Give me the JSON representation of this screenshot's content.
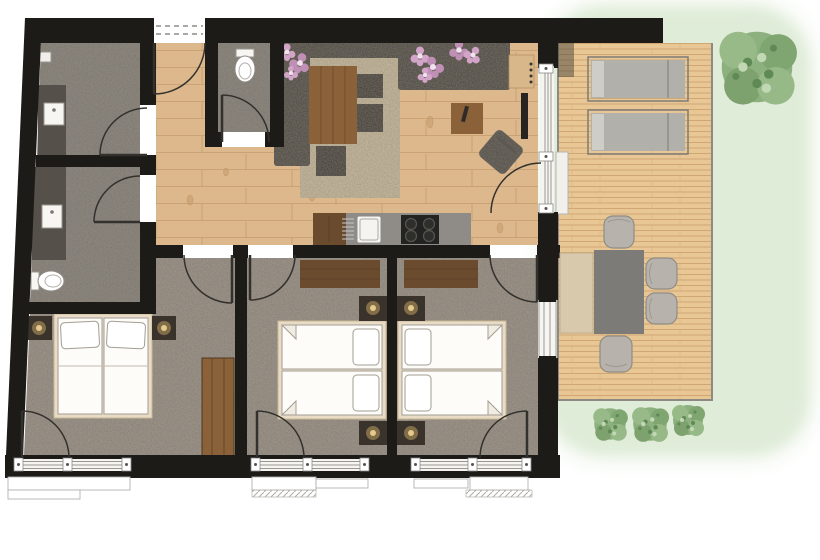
{
  "scene": {
    "kind": "apartment-floor-plan",
    "view": "top-down"
  },
  "palette": {
    "background": "#ffffff",
    "wall": "#1d1b18",
    "wood_floor": "#dcb88c",
    "tile": "#938d85",
    "carpet": "#a29a8f",
    "rug": "#cabda3",
    "sofa": "#403d39",
    "deck": "#e8c795",
    "deck_edge": "#8d8a84",
    "grass": "#dfecd8",
    "grass_halo": "#eef5ea",
    "tree": "#8cb07e",
    "bed_frame": "#e9dcc6",
    "bed_linen": "#fdfcf8",
    "pillow_accent": "#d2a4c8",
    "pillow_accent_dark": "#bf8fb5",
    "furniture_wood": "#8a6138",
    "dark_wood": "#6b4b2d",
    "counter": "#8f8c87",
    "cooktop": "#232321",
    "sink": "#f5f4f1",
    "lounger": "#b2b0ab",
    "outdoor_chair": "#b7b3ac",
    "outdoor_table": "#7d7b78",
    "bench": "#d9c9ac",
    "lamp_glow": "#caa768",
    "glazing": "#9a9792",
    "window_frame": "#f6f5f2",
    "door_arc": "#33312d"
  },
  "rooms": [
    {
      "name": "shower-room",
      "floor": "tile",
      "fixtures": [
        "vanity-washbasin",
        "swing-door"
      ]
    },
    {
      "name": "bathroom",
      "floor": "tile",
      "fixtures": [
        "vanity-washbasin",
        "toilet",
        "swing-door"
      ]
    },
    {
      "name": "wc",
      "floor": "tile",
      "fixtures": [
        "toilet",
        "swing-door"
      ]
    },
    {
      "name": "entrance-hall",
      "floor": "wood",
      "fixtures": [
        "entrance-door"
      ]
    },
    {
      "name": "living-dining-kitchen",
      "floor": "wood",
      "fixtures": [
        "corner-sofa",
        "flower-pillows",
        "rug",
        "coffee-table",
        "side-cubes",
        "stool",
        "side-table",
        "armchair",
        "tv",
        "wall-shelf",
        "kitchen-counter",
        "sink",
        "cooktop",
        "terrace-glass-door"
      ]
    },
    {
      "name": "bedroom-west",
      "floor": "carpet",
      "fixtures": [
        "double-bed",
        "nightstand",
        "nightstand",
        "wardrobe",
        "garden-door",
        "window"
      ]
    },
    {
      "name": "bedroom-middle",
      "floor": "carpet",
      "fixtures": [
        "double-bed",
        "nightstand",
        "nightstand",
        "sideboard",
        "garden-door",
        "window"
      ]
    },
    {
      "name": "bedroom-east",
      "floor": "carpet",
      "fixtures": [
        "double-bed",
        "nightstand",
        "nightstand",
        "sideboard",
        "garden-door",
        "window"
      ]
    },
    {
      "name": "terrace",
      "floor": "deck",
      "fixtures": [
        "sun-lounger",
        "sun-lounger",
        "dining-table",
        "bench",
        "chair",
        "chair",
        "chair",
        "chair",
        "step"
      ]
    },
    {
      "name": "garden",
      "floor": "grass",
      "fixtures": [
        "tree",
        "bush",
        "bush",
        "bush"
      ]
    }
  ]
}
